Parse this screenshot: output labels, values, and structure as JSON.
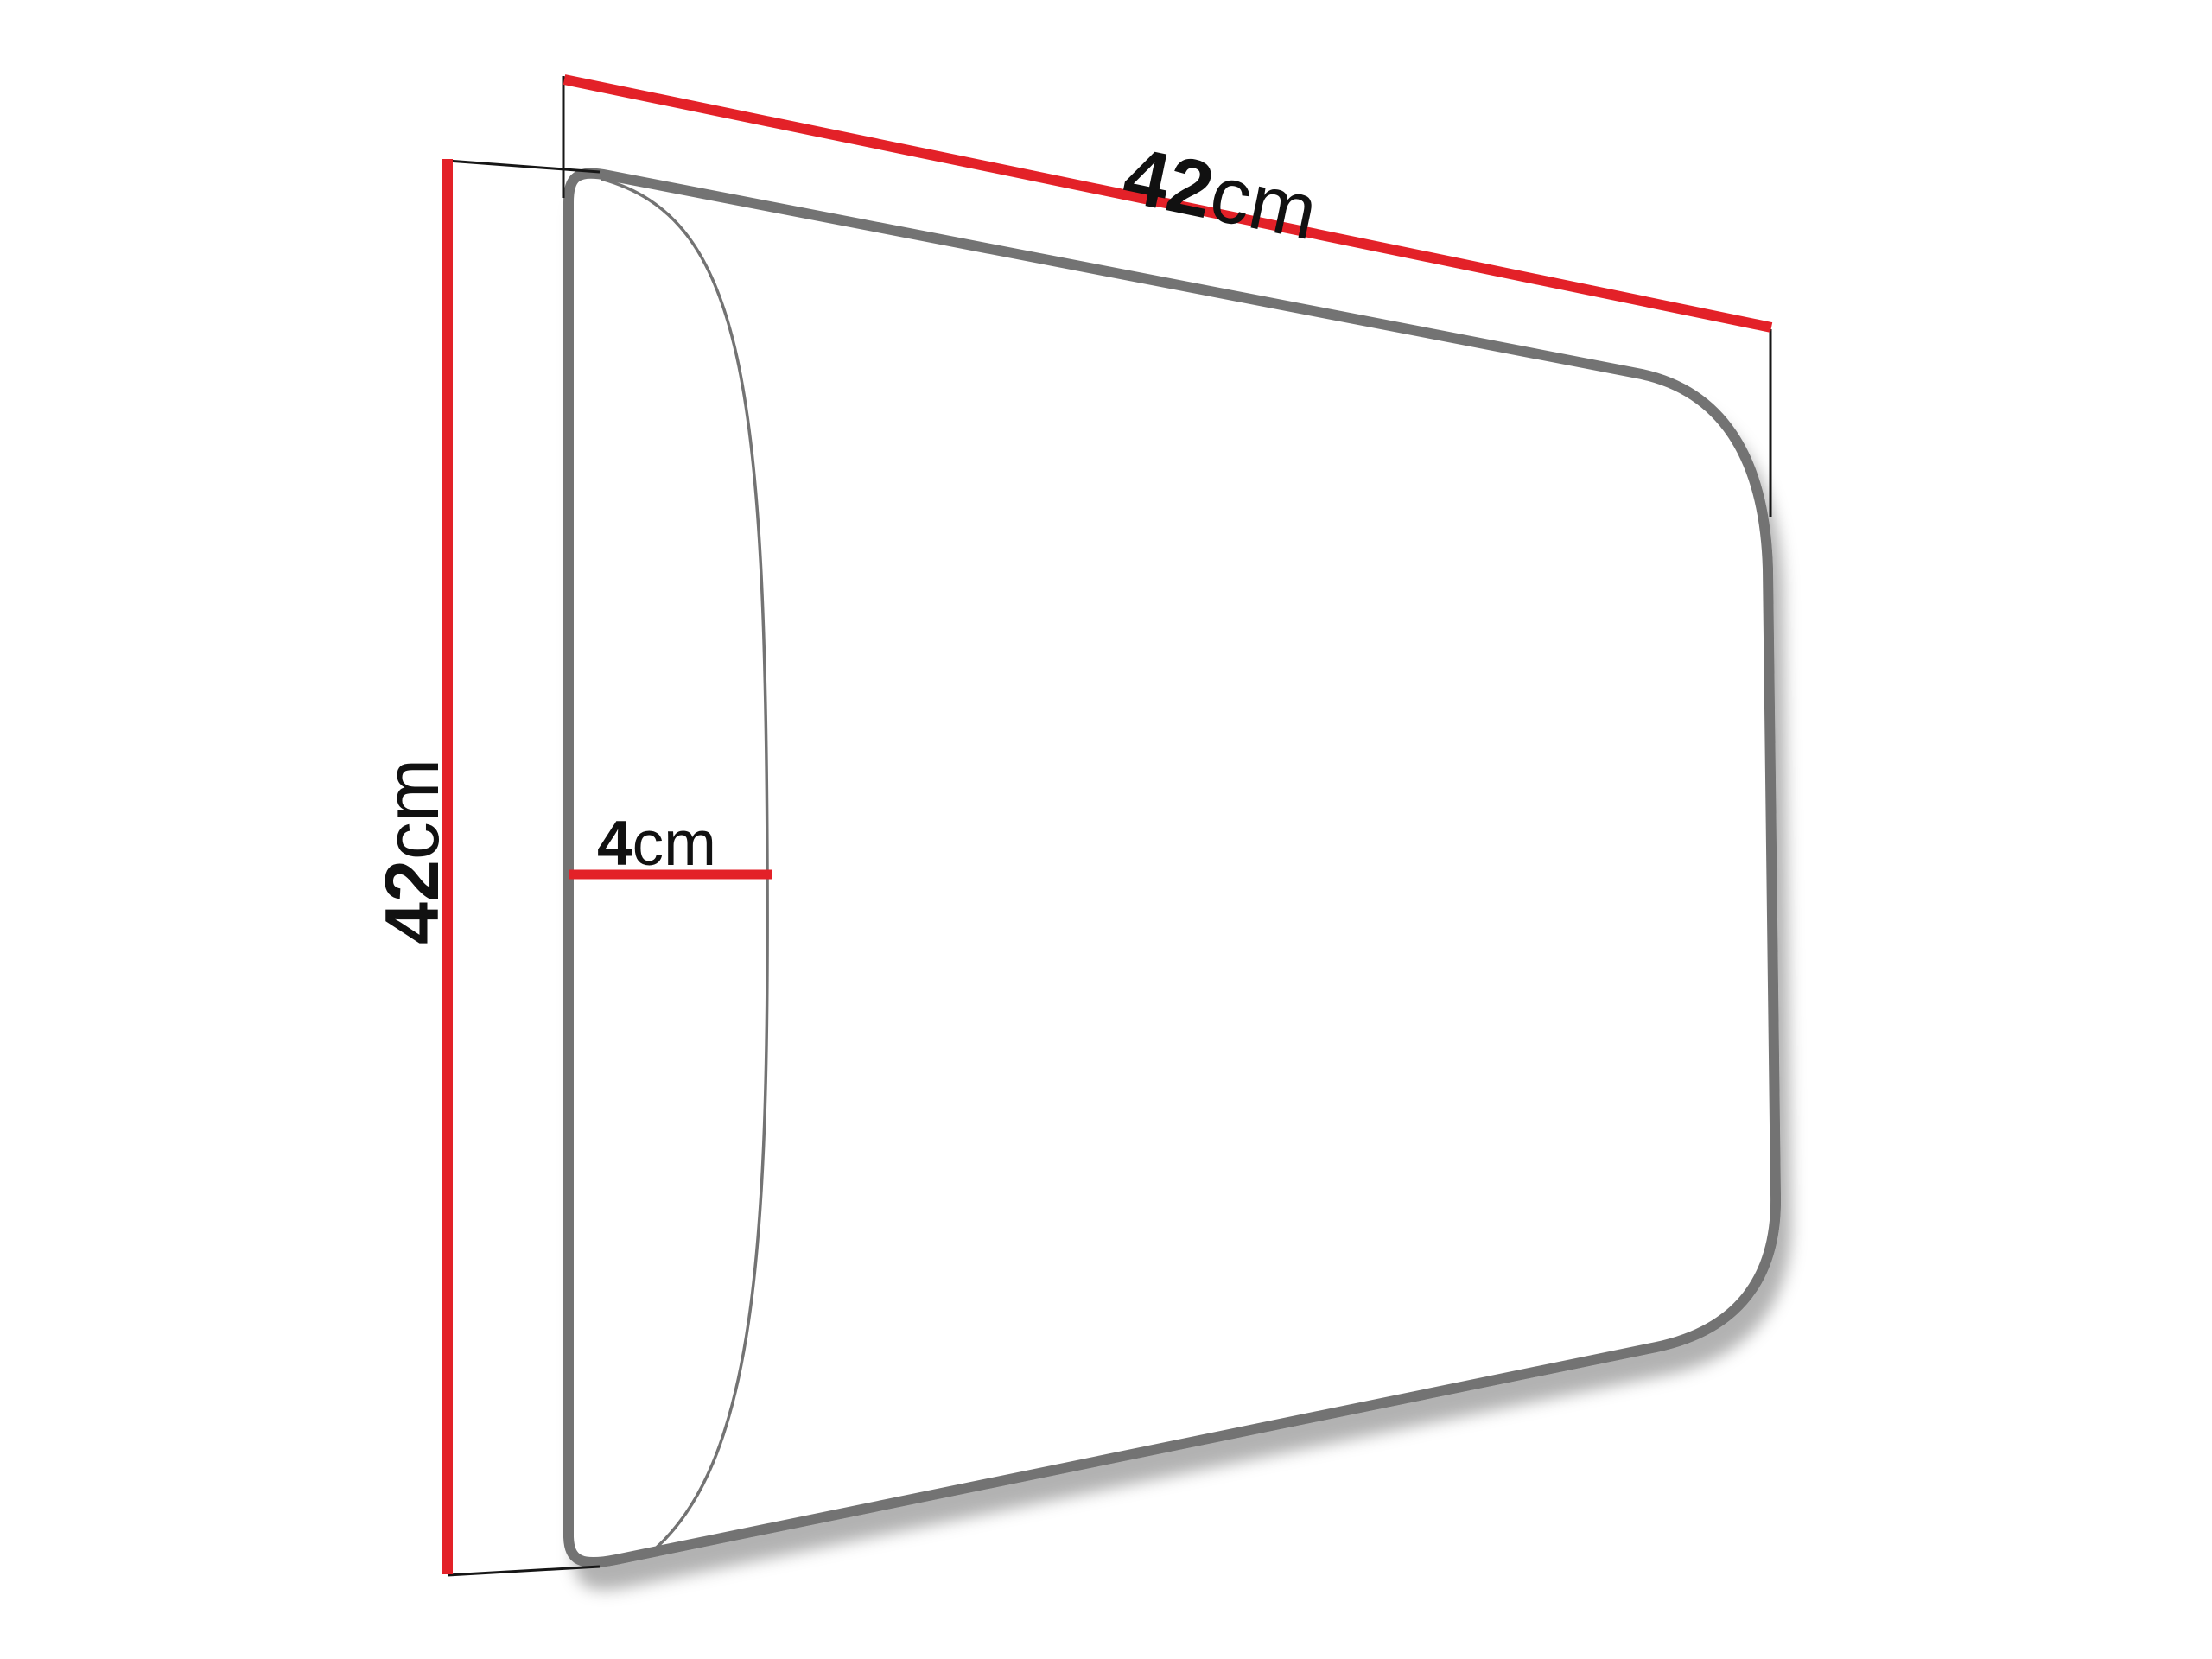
{
  "figure": {
    "title": "Upholstered wall panel dimension diagram",
    "background_color": "#ffffff",
    "colors": {
      "dimension_line": "#e32128",
      "panel_outline": "#737373",
      "panel_fill": "#ffffff",
      "extension_line": "#161616",
      "label_text": "#111111"
    },
    "labels": {
      "width": {
        "value": "42",
        "unit": "cm"
      },
      "height": {
        "value": "42",
        "unit": "cm"
      },
      "depth": {
        "value": "4",
        "unit": "cm"
      }
    }
  }
}
